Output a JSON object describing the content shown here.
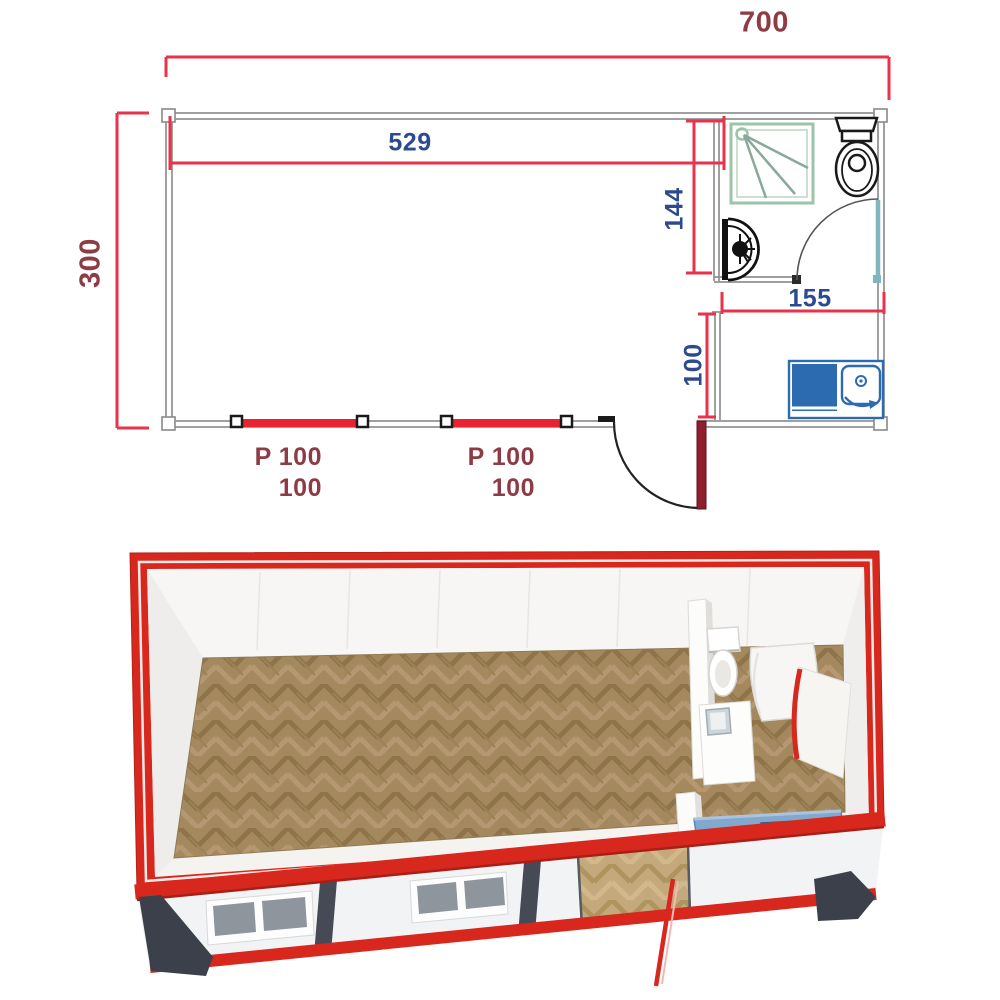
{
  "page": {
    "background": "#ffffff"
  },
  "floor_plan": {
    "overall_width": "700",
    "overall_depth": "300",
    "main_room_width": "529",
    "bathroom_depth": "144",
    "bathroom_width": "155",
    "kitchenette_depth": "100",
    "windows": [
      {
        "line1": "P 100",
        "line2": "100"
      },
      {
        "line1": "P 100",
        "line2": "100"
      }
    ],
    "colors": {
      "dimension_line": "#e8334a",
      "overall_label": "#8d3b44",
      "interior_label": "#2b4a8f",
      "wall": "#909090",
      "window_bar": "#e8222e",
      "entrance_door_leaf": "#8f1f2c",
      "shower_symbol": "#9cc4a8",
      "bath_door_leaf": "#7fb6c0",
      "fixture_outline": "#1a1a1a",
      "kitchen_unit": "#2d6bb0"
    }
  },
  "render_3d": {
    "colors": {
      "frame_red": "#d8281e",
      "corner_post_dark": "#3b404b",
      "wall_white": "#f2f3f5",
      "floor_wood": "#a5895e",
      "kitchen_counter_blue": "#82a8cd",
      "kitchen_sink_blue": "#3f6ea6",
      "window_glass": "#8e959d"
    }
  }
}
